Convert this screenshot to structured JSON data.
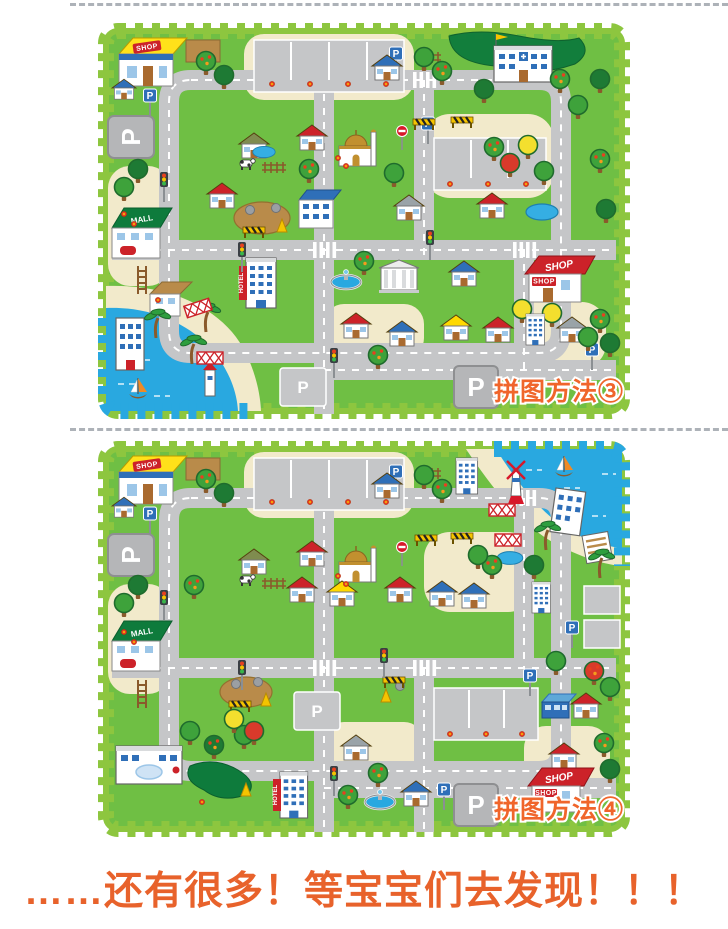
{
  "mats": {
    "mat1": {
      "label": "拼图方法③",
      "water_corner": "bottom-left"
    },
    "mat2": {
      "label": "拼图方法④",
      "water_corner": "top-right"
    }
  },
  "signs": {
    "parking": "P",
    "shop": "SHOP",
    "hotel": "HOTEL",
    "mall": "MALL"
  },
  "slogan": {
    "text": "……还有很多！等宝宝们去发现！！！"
  },
  "palette": {
    "mat_green": "#6FBF44",
    "border_green": "#8DC63F",
    "road_gray": "#C5C6C8",
    "water_blue": "#29A8E0",
    "sand": "#F2EACB",
    "hedge_green": "#0E7B3C",
    "roof_red": "#CC2229",
    "roof_blue": "#2F6FB8",
    "shop_yellow": "#FFE11A",
    "label_orange": "#F0652B",
    "slogan_orange": "#E8622B"
  }
}
